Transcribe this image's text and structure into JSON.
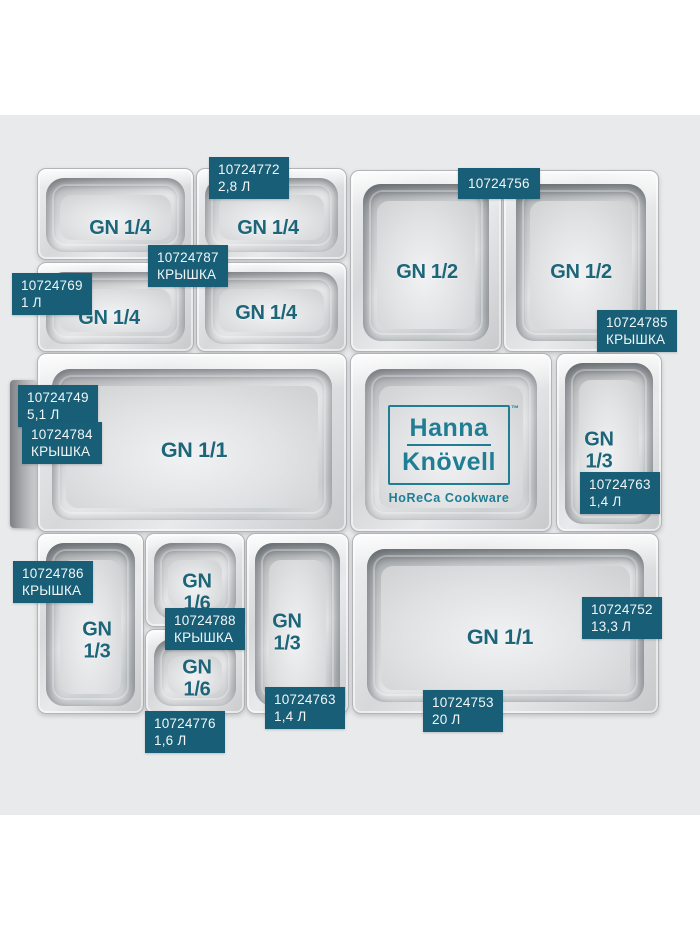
{
  "page": {
    "background": "#ffffff",
    "photo_background": "#e9eaeb"
  },
  "colors": {
    "tag_background": "#175e76",
    "tag_text": "#f2f6f7",
    "gn_text": "#1d6579",
    "brand_teal": "#1f7e94"
  },
  "brand": {
    "line1": "Hanna",
    "line2": "Knövell",
    "trademark": "™",
    "subtitle": "HoReCa Cookware"
  },
  "pans": [
    {
      "label": "GN 1/4"
    },
    {
      "label": "GN 1/4"
    },
    {
      "label": "GN 1/4"
    },
    {
      "label": "GN 1/4"
    },
    {
      "label": "GN 1/2"
    },
    {
      "label": "GN 1/2"
    },
    {
      "label": "GN 1/1"
    },
    {
      "label": ""
    },
    {
      "label": "GN\n1/3"
    },
    {
      "label": "GN\n1/3"
    },
    {
      "label": "GN 1/6"
    },
    {
      "label": "GN 1/6"
    },
    {
      "label": "GN\n1/3"
    },
    {
      "label": "GN 1/1"
    }
  ],
  "tags": [
    {
      "article": "10724772",
      "subtitle": "2,8 Л"
    },
    {
      "article": "10724756",
      "subtitle": ""
    },
    {
      "article": "10724769",
      "subtitle": "1 Л"
    },
    {
      "article": "10724787",
      "subtitle": "КРЫШКА"
    },
    {
      "article": "10724785",
      "subtitle": "КРЫШКА"
    },
    {
      "article": "10724749",
      "subtitle": "5,1 Л"
    },
    {
      "article": "10724784",
      "subtitle": "КРЫШКА"
    },
    {
      "article": "10724763",
      "subtitle": "1,4 Л"
    },
    {
      "article": "10724786",
      "subtitle": "КРЫШКА"
    },
    {
      "article": "10724788",
      "subtitle": "КРЫШКА"
    },
    {
      "article": "10724776",
      "subtitle": "1,6 Л"
    },
    {
      "article": "10724763",
      "subtitle": "1,4 Л"
    },
    {
      "article": "10724752",
      "subtitle": "13,3 Л"
    },
    {
      "article": "10724753",
      "subtitle": "20 Л"
    }
  ]
}
